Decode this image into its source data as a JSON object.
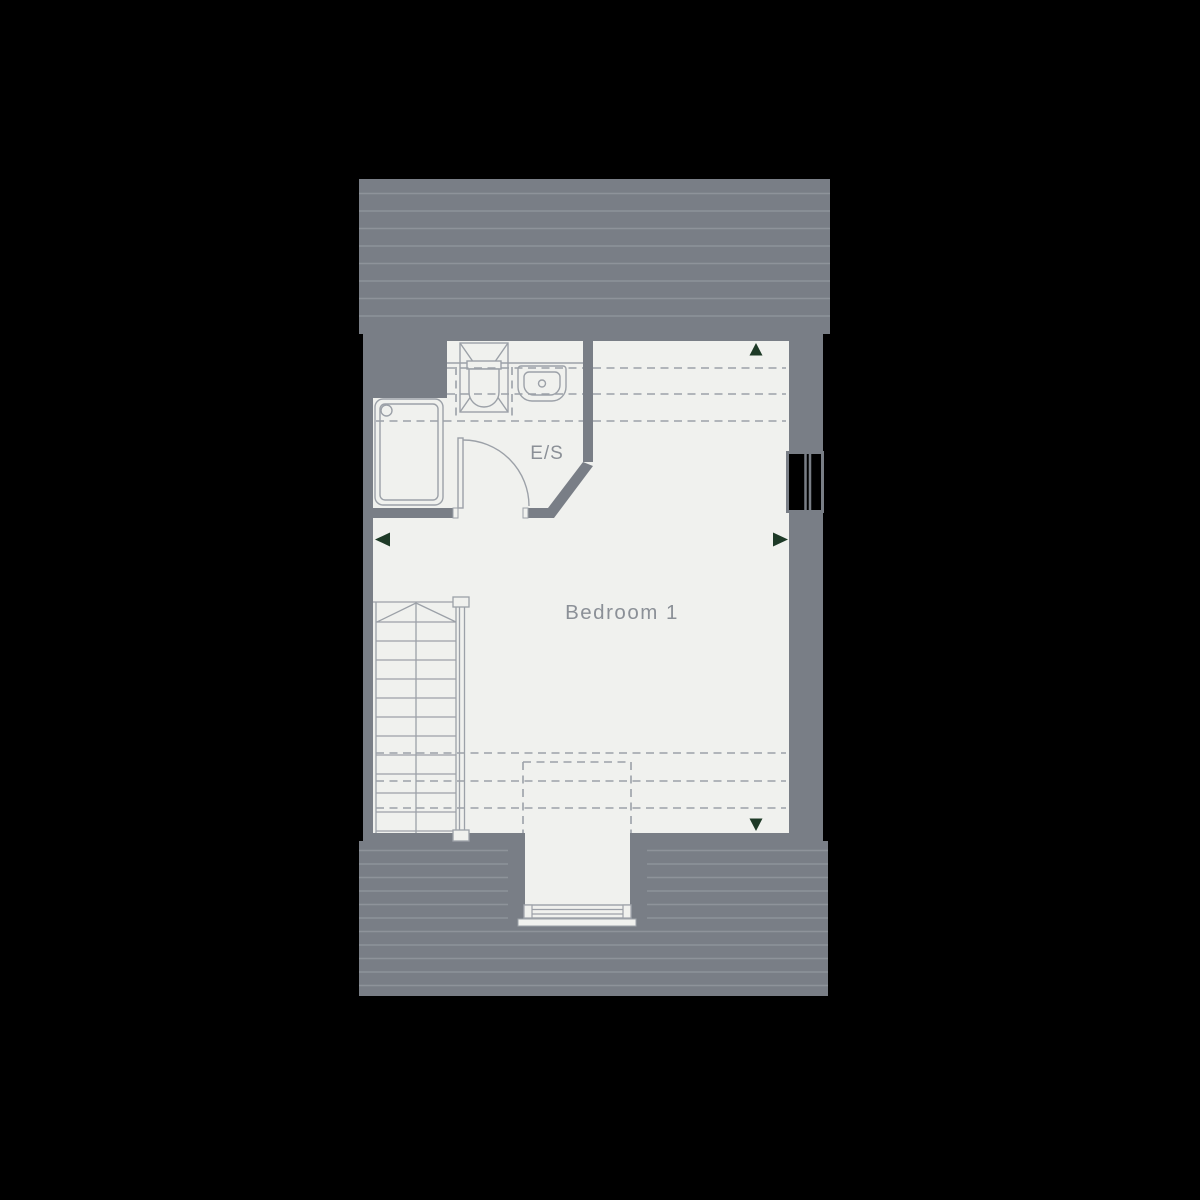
{
  "floorplan": {
    "floor_label": "",
    "rooms": [
      {
        "id": "ensuite",
        "label": "E/S"
      },
      {
        "id": "bedroom",
        "label": "Bedroom 1"
      }
    ],
    "fixtures": [
      "shower-enclosure",
      "wc",
      "basin",
      "bath",
      "staircase",
      "ensuite-door",
      "eaves-window",
      "dormer-window"
    ],
    "arrows": [
      {
        "direction": "up"
      },
      {
        "direction": "left"
      },
      {
        "direction": "right"
      },
      {
        "direction": "down"
      }
    ],
    "dashed_lines_meaning": "reduced-head-height",
    "colors": {
      "background": "#000000",
      "roof": "#797E86",
      "roof_stripe": "#8E939A",
      "wall": "#797E86",
      "floor": "#F0F1EE",
      "fixture_line": "#9CA1A8",
      "dashed_line": "#9CA1A8",
      "label_text": "#8B9097",
      "arrow": "#1E3A27",
      "window_glass": "#000000"
    }
  }
}
